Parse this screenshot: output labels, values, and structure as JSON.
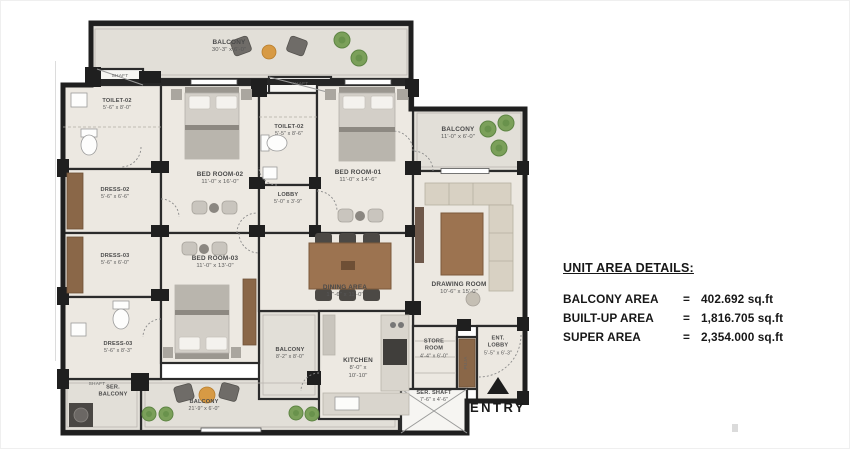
{
  "plan": {
    "rooms": {
      "balcony_top": {
        "line1": "BALCONY",
        "line2": "30'-3\" x 6'-0\""
      },
      "shaft_tl": {
        "line1": "SHAFT"
      },
      "toilet_02_a": {
        "line1": "TOILET-02",
        "line2": "5'-6\" x 8'-0\""
      },
      "dress_02": {
        "line1": "DRESS-02",
        "line2": "5'-6\" x 6'-6\""
      },
      "dress_03": {
        "line1": "DRESS-03",
        "line2": "5'-6\" x 6'-0\""
      },
      "dress_03_b": {
        "line1": "DRESS-03",
        "line2": "5'-6\" x 8'-3\""
      },
      "shaft_bl": {
        "line1": "SHAFT"
      },
      "ser_balcony": {
        "line1": "SER.",
        "line2": "BALCONY"
      },
      "bed_room_02": {
        "line1": "BED ROOM-02",
        "line2": "11'-0\" x 16'-0\""
      },
      "shaft_mid": {
        "line1": "SHAFT"
      },
      "toilet_02_b": {
        "line1": "TOILET-02",
        "line2": "5'-5\" x 8'-6\""
      },
      "lobby": {
        "line1": "LOBBY",
        "line2": "5'-0\" x 3'-9\""
      },
      "bed_room_01": {
        "line1": "BED ROOM-01",
        "line2": "11'-0\" x 14'-6\""
      },
      "balcony_right": {
        "line1": "BALCONY",
        "line2": "11'-0\" x 6'-0\""
      },
      "bed_room_03": {
        "line1": "BED ROOM-03",
        "line2": "11'-0\" x 13'-0\""
      },
      "dining_area": {
        "line1": "DINING AREA",
        "line2": "17'-6\" x 11'-0\""
      },
      "drawing_room": {
        "line1": "DRAWING ROOM",
        "line2": "10'-6\" x 15'-0\""
      },
      "balcony_kitchen": {
        "line1": "BALCONY",
        "line2": "8'-2\" x 8'-0\""
      },
      "kitchen": {
        "line1": "KITCHEN",
        "line2": "8'-0\" x",
        "line3": "10'-10\""
      },
      "store_room": {
        "line1": "STORE",
        "line2": "ROOM",
        "line3": "4'-4\" x 6'-0\""
      },
      "puja": {
        "line1": "PUJA"
      },
      "ent_lobby": {
        "line1": "ENT.",
        "line2": "LOBBY",
        "line3": "5'-5\" x 6'-3\""
      },
      "ser_shaft": {
        "line1": "SER. SHAFT",
        "line2": "7'-6\" x 4'-6\""
      },
      "balcony_bottom": {
        "line1": "BALCONY",
        "line2": "21'-9\" x 6'-0\""
      }
    },
    "entry_label": "ENTRY",
    "colors": {
      "wall": "#1f1f1f",
      "balcony_floor": "#e2dfd8",
      "room_floor": "#ece8e1",
      "wood": "#9c7350",
      "tree": "#7ba05a",
      "table_orange": "#d79a44"
    }
  },
  "area_details": {
    "title": "UNIT AREA DETAILS:",
    "rows": [
      {
        "label": "BALCONY AREA",
        "eq": "=",
        "value": "402.692  sq.ft"
      },
      {
        "label": "BUILT-UP AREA",
        "eq": "=",
        "value": "1,816.705  sq.ft"
      },
      {
        "label": "SUPER AREA",
        "eq": "=",
        "value": "2,354.000 sq.ft"
      }
    ]
  }
}
